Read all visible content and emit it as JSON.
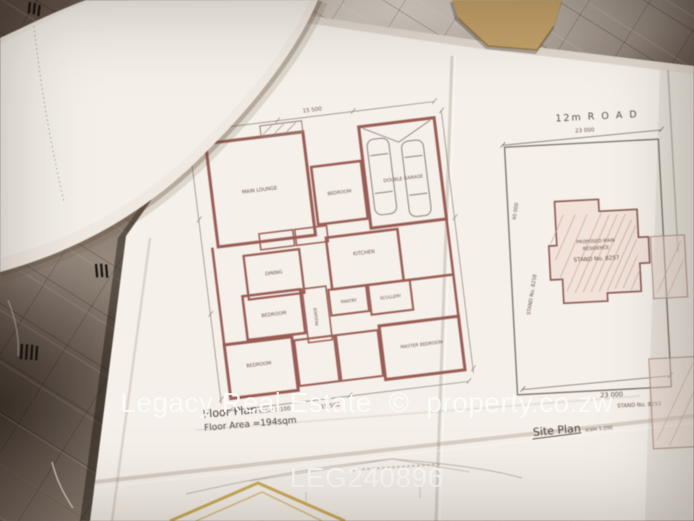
{
  "watermark": {
    "line1": "Legacy Real Estate  ©  property.co.zw",
    "line2": "LEG240896"
  },
  "floor_plan": {
    "title": "Floor Plan",
    "scale": "scale 1:100",
    "area": "Floor Area =194sqm",
    "dim_top": "15 500",
    "dim_bottom": "15 500",
    "rooms": {
      "lounge": "MAIN LOUNGE",
      "bedroom_top": "BEDROOM",
      "garage": "DOUBLE GARAGE",
      "dining": "DINING",
      "kitchen": "KITCHEN",
      "passage": "PASSAGE",
      "pantry": "PANTRY",
      "scullery": "SCULLERY",
      "bedroom_mid": "BEDROOM",
      "bedroom_bottom": "BEDROOM",
      "master": "MASTER BEDROOM"
    }
  },
  "site_plan": {
    "road": "12m R O A D",
    "dim_top": "23 000",
    "dim_bottom": "23 000",
    "dim_left": "40 000",
    "stand_left": "STAND No. 8258",
    "stand_bottom": "STAND No. 8293",
    "building": {
      "line1": "PROPOSED MAIN",
      "line2": "RESIDENCE",
      "line3": "STAND No. 8257"
    },
    "title": "Site Plan",
    "scale": "scale 1:200"
  },
  "colors": {
    "wall": "#9a5d56",
    "ink": "#6a544d",
    "paper": "#f5f0e9",
    "fabric": "#7d6e63",
    "watermark_text": "rgba(252,252,250,0.82)",
    "roof_highlight": "#c9a54d"
  }
}
